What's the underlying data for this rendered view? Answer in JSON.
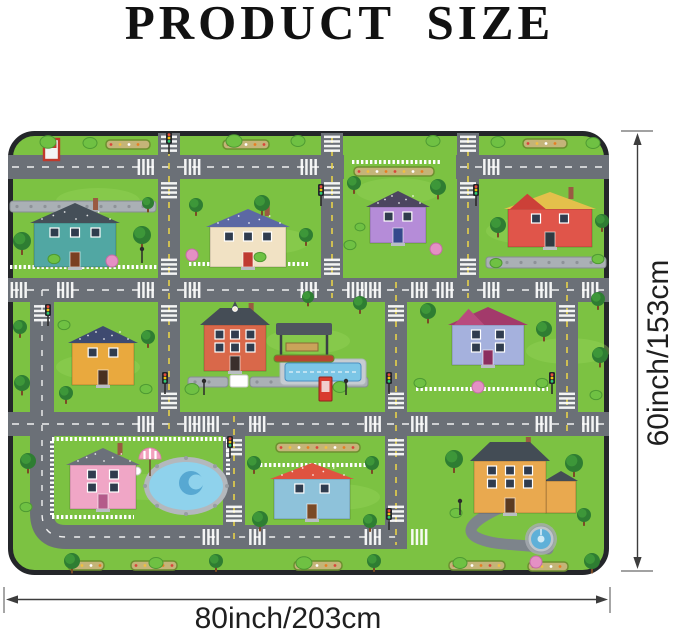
{
  "title": "PRODUCT SIZE",
  "dimension_labels": {
    "height": "60inch/153cm",
    "width": "80inch/203cm"
  },
  "colors": {
    "grass": "#7cc242",
    "grass_light": "#97d45a",
    "road": "#6b7077",
    "dash_white": "#f0f0f0",
    "dash_yellow": "#e6d24a",
    "stone": "#aab0b5",
    "stone_dark": "#8d9298",
    "fence": "#ffffff",
    "water": "#7cc6e6",
    "water_light": "#8fd2ec",
    "water_dark": "#57a8d2",
    "border": "#24262a",
    "trunk": "#7c4a26",
    "tree_dark": "#2e7d32",
    "tree_mid": "#3f9a3a",
    "bush": "#6fc143",
    "bush_stroke": "#4e9a33",
    "pink_bush": "#e490c4",
    "bed_base": "#c4b478",
    "driveway": "#7d848b",
    "arrow": "#3d3d3d",
    "text": "#1f1f1f"
  },
  "scene": {
    "roads": {
      "horizontal": [
        [
          0,
          336,
          24
        ],
        [
          448,
          601,
          24
        ],
        [
          0,
          601,
          147
        ],
        [
          0,
          601,
          281
        ]
      ],
      "vertical": [
        [
          150,
          2,
          305
        ],
        [
          313,
          2,
          171
        ],
        [
          449,
          2,
          171
        ],
        [
          377,
          147,
          418
        ],
        [
          548,
          147,
          305
        ],
        [
          215,
          281,
          418
        ]
      ],
      "ring": "M 34 159 L 34 382 Q 34 406 58 406 L 388 406",
      "driveway": "M 494 376 C 468 388 452 400 472 408 S 516 412 540 418"
    },
    "intersections": [
      [
        161,
        36,
        "lrtb"
      ],
      [
        324,
        36,
        "ltb"
      ],
      [
        460,
        36,
        "rtb"
      ],
      [
        34,
        159,
        "lrb"
      ],
      [
        161,
        159,
        "lrtb"
      ],
      [
        324,
        159,
        "lrt"
      ],
      [
        388,
        159,
        "lrb"
      ],
      [
        460,
        159,
        "lrt"
      ],
      [
        559,
        159,
        "lrb"
      ],
      [
        161,
        293,
        "lrt"
      ],
      [
        226,
        293,
        "lrb"
      ],
      [
        388,
        293,
        "lrtb"
      ],
      [
        559,
        293,
        "lrt"
      ],
      [
        226,
        406,
        "lrt"
      ],
      [
        388,
        406,
        "lrt"
      ]
    ],
    "traffic_lights": [
      [
        161,
        10
      ],
      [
        313,
        62
      ],
      [
        468,
        62
      ],
      [
        40,
        182
      ],
      [
        157,
        250
      ],
      [
        381,
        250
      ],
      [
        544,
        250
      ],
      [
        222,
        314
      ],
      [
        381,
        386
      ]
    ],
    "lamps": [
      [
        134,
        118
      ],
      [
        196,
        250
      ],
      [
        338,
        250
      ],
      [
        452,
        370
      ]
    ],
    "houses": [
      {
        "id": "teal",
        "x": 26,
        "y": 92,
        "w": 82,
        "h": 44,
        "rh": 20,
        "body": "#51a7a3",
        "roof": "#454f58",
        "door": "#7a3f22",
        "wc": 3,
        "wr": 1,
        "dots": true,
        "chimney": true
      },
      {
        "id": "cream",
        "x": 202,
        "y": 96,
        "w": 76,
        "h": 40,
        "rh": 18,
        "body": "#f1e2c4",
        "roof": "#5c68a4",
        "door": "#bf3b32",
        "wc": 3,
        "wr": 1,
        "dots": true,
        "chimney": true
      },
      {
        "id": "purple",
        "x": 362,
        "y": 76,
        "w": 56,
        "h": 36,
        "rh": 16,
        "body": "#b58cd8",
        "roof": "#4c4560",
        "door": "#35498c",
        "wc": 2,
        "wr": 1,
        "dots": true
      },
      {
        "id": "red",
        "x": 500,
        "y": 78,
        "w": 84,
        "h": 38,
        "rh": 17,
        "body": "#e0554a",
        "roof": "#e4c04b",
        "door": "#303a42",
        "wc": 2,
        "wr": 1,
        "gable2": "#cc4038",
        "chimney": true
      },
      {
        "id": "orange",
        "x": 64,
        "y": 212,
        "w": 62,
        "h": 42,
        "rh": 17,
        "body": "#e9a93e",
        "roof": "#3e4a70",
        "door": "#4a3020",
        "wc": 2,
        "wr": 1,
        "dots": true
      },
      {
        "id": "mansion",
        "x": 196,
        "y": 194,
        "w": 62,
        "h": 46,
        "rh": 17,
        "body": "#d9684a",
        "roof": "#454d56",
        "door": "#3a2f2c",
        "wc": 3,
        "wr": 2,
        "hip": true,
        "midgable": true,
        "chimney": true
      },
      {
        "id": "lavender",
        "x": 444,
        "y": 194,
        "w": 72,
        "h": 40,
        "rh": 18,
        "body": "#a5b1dd",
        "roof": "#a33a6b",
        "door": "#8c2f5f",
        "wc": 2,
        "wr": 2,
        "gable2": "#b94b7e"
      },
      {
        "id": "pink",
        "x": 62,
        "y": 334,
        "w": 66,
        "h": 44,
        "rh": 17,
        "body": "#f0a6c6",
        "roof": "#6b707a",
        "door": "#b45a8a",
        "wc": 2,
        "wr": 2,
        "dots": true,
        "chimney": true
      },
      {
        "id": "cottage",
        "x": 266,
        "y": 348,
        "w": 76,
        "h": 40,
        "rh": 16,
        "body": "#8ec2da",
        "roof": "#df5340",
        "door": "#7a4a26",
        "wc": 2,
        "wr": 1,
        "dots": true
      },
      {
        "id": "manor",
        "x": 466,
        "y": 330,
        "w": 72,
        "h": 52,
        "rh": 19,
        "body": "#e9a94f",
        "roof": "#434c55",
        "door": "#5a3a20",
        "wc": 3,
        "wr": 2,
        "hip": true,
        "chimney": true,
        "wing": [
          538,
          350,
          30,
          32
        ]
      }
    ],
    "walls": [
      [
        2,
        70,
        146,
        11
      ],
      [
        478,
        126,
        120,
        11
      ],
      [
        180,
        246,
        40,
        10
      ],
      [
        242,
        246,
        118,
        10
      ]
    ],
    "gates": [
      [
        222,
        244,
        18,
        12
      ]
    ],
    "fences": [
      [
        2,
        136,
        150,
        136
      ],
      [
        181,
        133,
        300,
        133
      ],
      [
        344,
        31,
        432,
        31
      ],
      [
        408,
        258,
        540,
        258
      ],
      [
        44,
        308,
        220,
        308
      ],
      [
        44,
        310,
        44,
        384
      ],
      [
        220,
        310,
        220,
        344
      ],
      [
        44,
        386,
        126,
        386
      ],
      [
        252,
        334,
        360,
        334
      ]
    ],
    "flowerbeds": [
      [
        98,
        9,
        44
      ],
      [
        215,
        9,
        46
      ],
      [
        346,
        36,
        80
      ],
      [
        515,
        8,
        44
      ],
      [
        123,
        430,
        46
      ],
      [
        286,
        430,
        48
      ],
      [
        441,
        430,
        56
      ],
      [
        520,
        431,
        40
      ],
      [
        60,
        430,
        36
      ],
      [
        268,
        312,
        84
      ]
    ],
    "pond": {
      "cx": 178,
      "cy": 355,
      "rx": 37,
      "ry": 24
    },
    "umbrella": {
      "x": 142,
      "y": 328
    },
    "pool": {
      "x": 272,
      "y": 228,
      "w": 86,
      "h": 26
    },
    "pergola": {
      "x": 268,
      "y": 192,
      "w": 56,
      "h": 12
    },
    "phone_booth": {
      "x": 311,
      "y": 246,
      "w": 13,
      "h": 24
    },
    "fountain": {
      "cx": 533,
      "cy": 408
    },
    "sign": {
      "x": 36,
      "y": 8
    },
    "grass_patches": [
      [
        90,
        70
      ],
      [
        260,
        110
      ],
      [
        520,
        100
      ],
      [
        90,
        236
      ],
      [
        300,
        210
      ],
      [
        560,
        220
      ],
      [
        140,
        356
      ],
      [
        330,
        366
      ],
      [
        510,
        356
      ],
      [
        390,
        60
      ]
    ],
    "trees": [
      [
        40,
        11,
        8,
        "b"
      ],
      [
        82,
        12,
        7,
        "b"
      ],
      [
        226,
        10,
        8,
        "b"
      ],
      [
        290,
        10,
        7,
        "b"
      ],
      [
        425,
        10,
        7,
        "b"
      ],
      [
        490,
        11,
        7,
        "b"
      ],
      [
        585,
        12,
        7,
        "b"
      ],
      [
        14,
        110,
        9,
        "d"
      ],
      [
        134,
        104,
        9,
        "d"
      ],
      [
        46,
        128,
        6,
        "b"
      ],
      [
        104,
        130,
        6,
        "p"
      ],
      [
        140,
        72,
        6,
        "d"
      ],
      [
        188,
        74,
        7,
        "d"
      ],
      [
        254,
        72,
        8,
        "d"
      ],
      [
        298,
        104,
        7,
        "d"
      ],
      [
        184,
        124,
        6,
        "p"
      ],
      [
        252,
        126,
        6,
        "b"
      ],
      [
        346,
        52,
        7,
        "d"
      ],
      [
        430,
        56,
        8,
        "d"
      ],
      [
        342,
        114,
        6,
        "b"
      ],
      [
        428,
        118,
        6,
        "p"
      ],
      [
        352,
        96,
        5,
        "b"
      ],
      [
        490,
        94,
        8,
        "d"
      ],
      [
        594,
        90,
        7,
        "d"
      ],
      [
        488,
        132,
        6,
        "b"
      ],
      [
        590,
        128,
        6,
        "b"
      ],
      [
        12,
        196,
        7,
        "d"
      ],
      [
        14,
        252,
        8,
        "d"
      ],
      [
        56,
        194,
        6,
        "b"
      ],
      [
        140,
        206,
        7,
        "d"
      ],
      [
        138,
        258,
        6,
        "b"
      ],
      [
        58,
        262,
        7,
        "d"
      ],
      [
        184,
        258,
        7,
        "b"
      ],
      [
        332,
        256,
        7,
        "b"
      ],
      [
        300,
        166,
        6,
        "d"
      ],
      [
        352,
        172,
        7,
        "d"
      ],
      [
        420,
        180,
        8,
        "d"
      ],
      [
        412,
        252,
        6,
        "b"
      ],
      [
        470,
        256,
        6,
        "p"
      ],
      [
        536,
        198,
        8,
        "d"
      ],
      [
        534,
        252,
        6,
        "b"
      ],
      [
        590,
        168,
        7,
        "d"
      ],
      [
        592,
        224,
        8,
        "d"
      ],
      [
        588,
        264,
        6,
        "b"
      ],
      [
        20,
        330,
        8,
        "d"
      ],
      [
        18,
        376,
        6,
        "b"
      ],
      [
        246,
        332,
        7,
        "d"
      ],
      [
        252,
        388,
        8,
        "d"
      ],
      [
        364,
        332,
        7,
        "d"
      ],
      [
        362,
        390,
        7,
        "d"
      ],
      [
        446,
        328,
        9,
        "d"
      ],
      [
        448,
        382,
        6,
        "b"
      ],
      [
        566,
        332,
        9,
        "d"
      ],
      [
        576,
        384,
        7,
        "d"
      ],
      [
        64,
        430,
        8,
        "d"
      ],
      [
        148,
        432,
        7,
        "b"
      ],
      [
        208,
        430,
        7,
        "d"
      ],
      [
        296,
        432,
        8,
        "b"
      ],
      [
        366,
        430,
        7,
        "d"
      ],
      [
        452,
        432,
        7,
        "b"
      ],
      [
        584,
        430,
        8,
        "d"
      ],
      [
        528,
        431,
        6,
        "p"
      ]
    ]
  }
}
